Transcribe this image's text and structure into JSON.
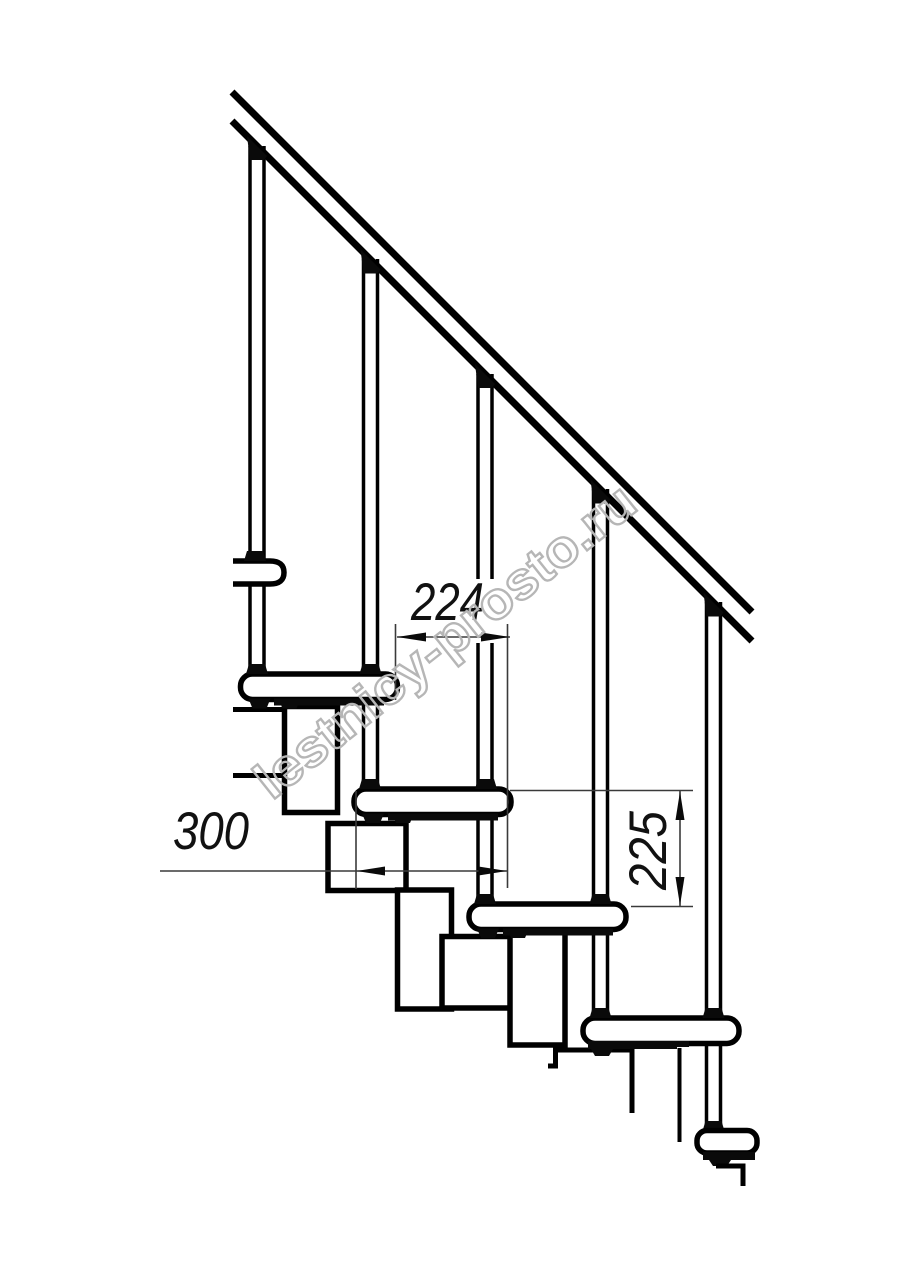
{
  "page": {
    "background_color": "#ffffff"
  },
  "drawing": {
    "type": "technical-line-drawing",
    "subject": "modular staircase side elevation with handrail, balusters, treads and stringer modules",
    "stroke_color": "#000000",
    "dimension_color": "#3a3a3a",
    "dimensions": {
      "tread_offset": {
        "value": "224"
      },
      "tread_depth": {
        "value": "300"
      },
      "step_rise": {
        "value": "225"
      }
    },
    "watermark": {
      "text": "lestnicy-prosto.ru",
      "color": "#b6b6b6"
    }
  }
}
